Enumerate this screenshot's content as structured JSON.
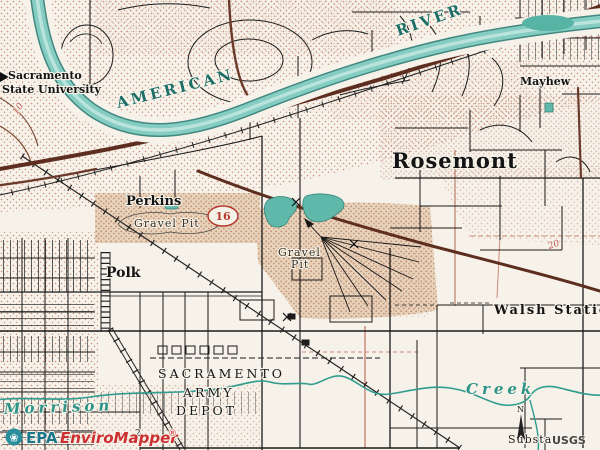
{
  "page": {
    "title": "EPA EnviroMapper topographic map view"
  },
  "colors": {
    "paper": "#f6f1e9",
    "water_fill": "#85ccc2",
    "water_edge": "#2e7d74",
    "water_label_teal": "#1d6e66",
    "stipple_pink": "#c9907b",
    "road_black": "#1c1c1c",
    "highway_brown": "#5d2e1f",
    "section_red": "#c0564a",
    "shield_red": "#b5382c",
    "epa_teal": "#19768b",
    "enviromapper_red": "#cc2f2f",
    "usgs_gray": "#454541"
  },
  "labels": {
    "sac_state_1": "Sacramento",
    "sac_state_2": "State University",
    "american": "AMERICAN",
    "river": "RIVER",
    "mayhew": "Mayhew",
    "rosemont": "Rosemont",
    "perkins": "Perkins",
    "gravel_pit_w": "Gravel Pit",
    "gravel_c_1": "Gravel",
    "gravel_c_2": "Pit",
    "polk": "Polk",
    "walsh_station": "Walsh Station",
    "depot_1": "SACRAMENTO",
    "depot_2": "ARMY",
    "depot_3": "DEPOT",
    "creek": "Creek",
    "morrison": "Morrison",
    "substation": "Substa",
    "north": "N"
  },
  "numbers": {
    "route_shield": "16",
    "section_20": "20",
    "grid_10": "10",
    "section_2": "2"
  },
  "branding": {
    "epa": "EPA",
    "product": "EnviroMapper",
    "registered": "®",
    "flower_icon": "❀",
    "usgs": "USGS"
  }
}
